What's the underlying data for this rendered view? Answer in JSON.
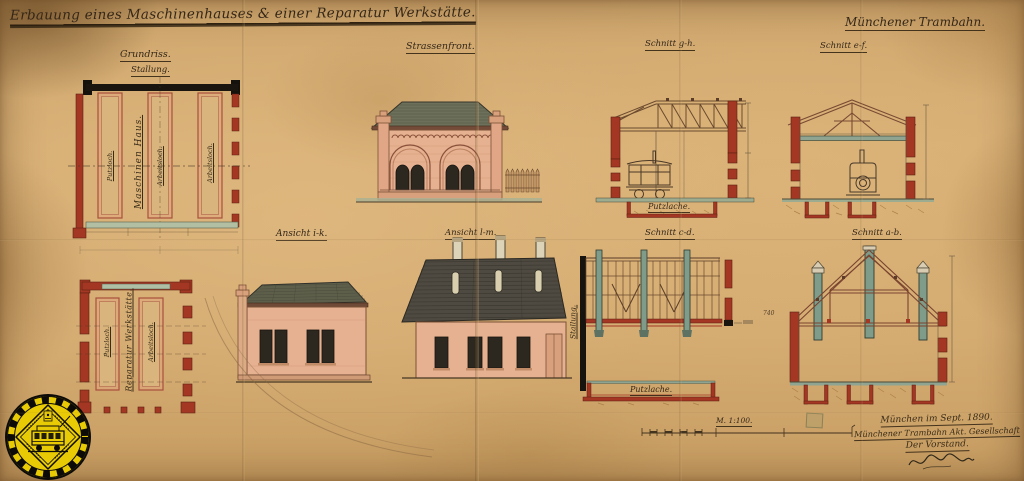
{
  "header": {
    "title": "Erbauung eines Maschinenhauses & einer Reparatur Werkstätte.",
    "company": "Münchener Trambahn."
  },
  "labels": {
    "grundriss": "Grundriss.",
    "stallung": "Stallung.",
    "strassenfront": "Strassenfront.",
    "schnitt_gh": "Schnitt g-h.",
    "schnitt_ef": "Schnitt e-f.",
    "ansicht_ik": "Ansicht i-k.",
    "ansicht_lm": "Ansicht l-m.",
    "schnitt_cd": "Schnitt c-d.",
    "schnitt_ab": "Schnitt a-b."
  },
  "plan_top": {
    "room": "Maschinen Haus.",
    "pit1": "Putzloch.",
    "pit2": "Arbeitsloch.",
    "pit3": "Arbeitsloch."
  },
  "plan_bottom": {
    "room": "Reparatur Werkstätte.",
    "pit1": "Putzloch.",
    "pit2": "Arbeitsloch."
  },
  "sections": {
    "gh_pit": "Putzlache.",
    "cd_pit": "Putzlache.",
    "cd_wall": "Stallung.",
    "ab_dim": "740"
  },
  "scale": {
    "label": "M. 1:100."
  },
  "signature": {
    "place_date": "München im Sept. 1890.",
    "company": "Münchener Trambahn Akt. Gesellschaft",
    "role": "Der Vorstand."
  },
  "badge": {
    "icon": "tram-icon"
  }
}
